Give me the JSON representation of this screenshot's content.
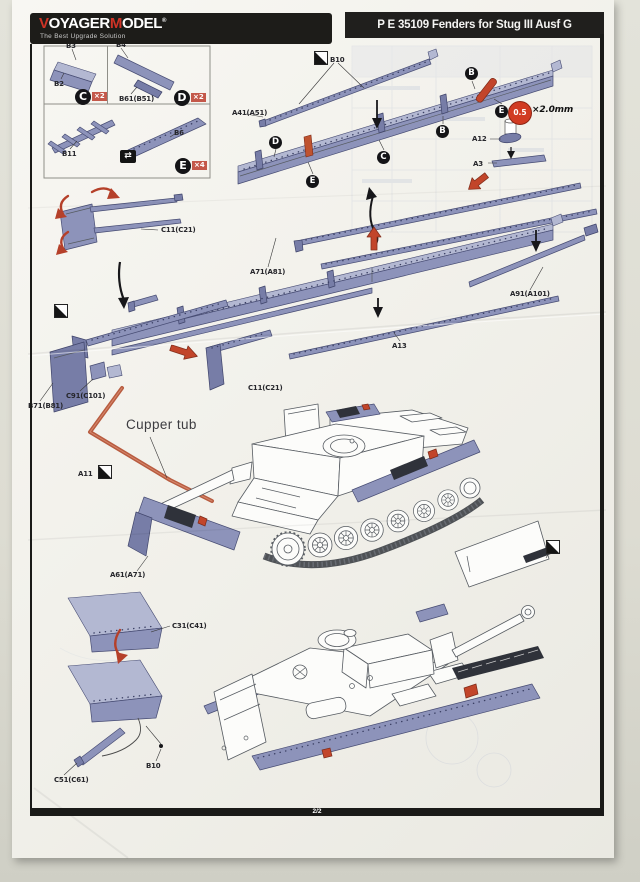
{
  "header": {
    "logo": {
      "v": "V",
      "oyager": "OYAGER",
      "m": "M",
      "odel": "ODEL",
      "reg": "®",
      "tagline": "The Best Upgrade Solution"
    },
    "title": "P E 35109  Fenders for Stug III Ausf G"
  },
  "footer": {
    "page": "2/2"
  },
  "partsbox": {
    "b3": "B3",
    "b2": "B2",
    "b4": "B4",
    "b61": "B61(B51)",
    "b11": "B11",
    "b6": "B6",
    "c": {
      "letter": "C",
      "qty": "×2"
    },
    "d": {
      "letter": "D",
      "qty": "×2"
    },
    "e": {
      "letter": "E",
      "qty": "×4"
    }
  },
  "diagram": {
    "b10_top": "B10",
    "a41": "A41(A51)",
    "a12": "A12",
    "a3": "A3",
    "wire": {
      "dia": "0.5",
      "len": "×2.0mm"
    },
    "c11_jack": "C11(C21)",
    "c11_corner": "C11(C21)",
    "a71": "A71(A81)",
    "a91": "A91(A101)",
    "a13": "A13",
    "b71": "B71(B81)",
    "c91": "C91(C101)",
    "cupper_tub": "Cupper tub",
    "a11": "A11",
    "a61": "A61(A71)",
    "c31": "C31(C41)",
    "c51": "C51(C61)",
    "b10_flap": "B10",
    "callouts": {
      "b1": "B",
      "b2": "B",
      "c": "C",
      "d": "D",
      "e1": "E",
      "e2": "E"
    }
  },
  "icons": {
    "transfer_glyph": "⇄"
  },
  "colors": {
    "part_blue": "#8d93ba",
    "part_blue_light": "#b3b8d2",
    "accent_red": "#c2452a",
    "bar_black": "#1d1c19",
    "logo_red": "#cf3326",
    "badge_red": "#c4584a"
  }
}
